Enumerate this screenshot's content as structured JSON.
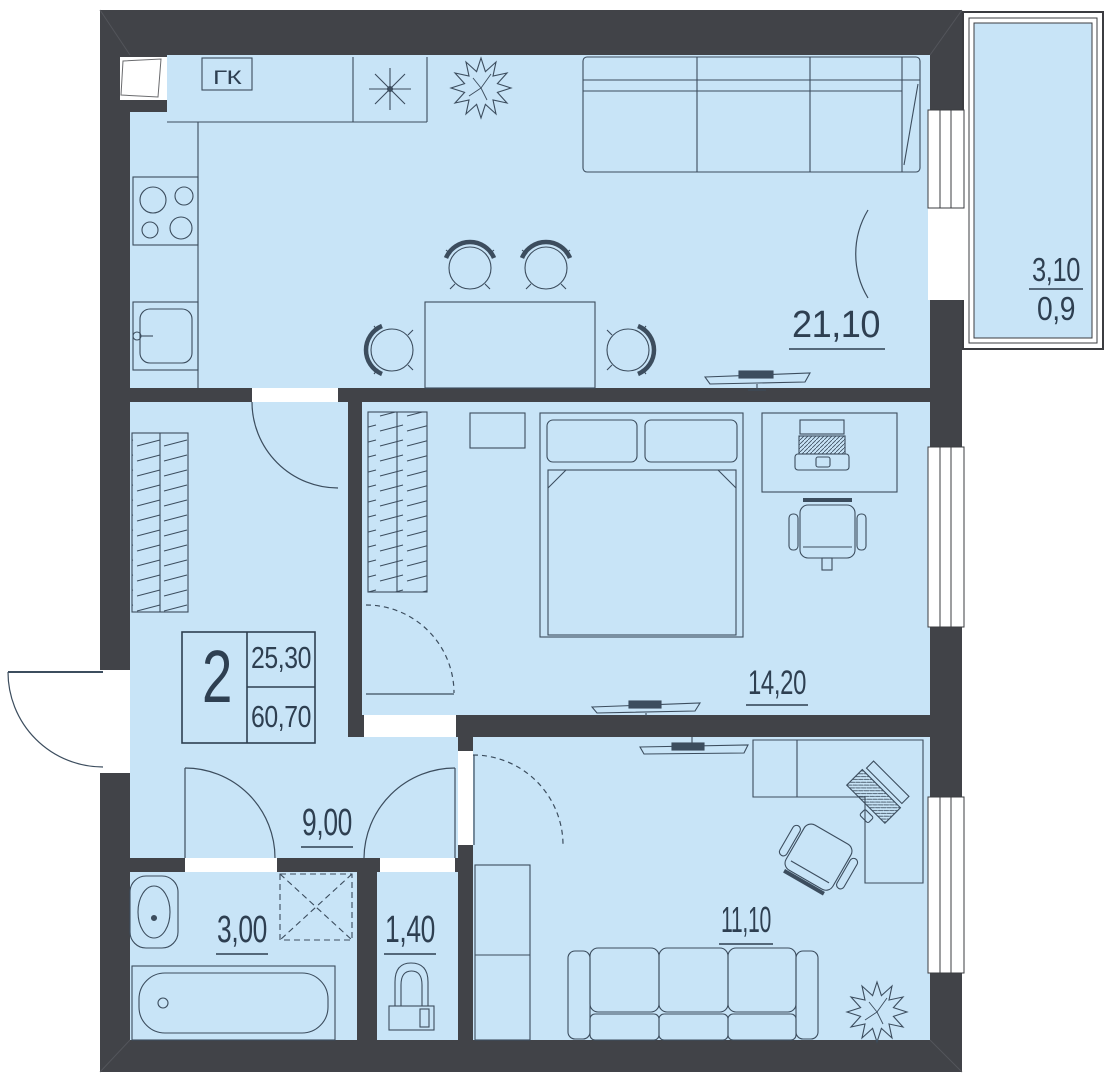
{
  "plan": {
    "stamp": {
      "rooms_count": "2",
      "living_area": "25,30",
      "total_area": "60,70"
    },
    "rooms": {
      "living_kitchen": {
        "area": "21,10"
      },
      "bedroom": {
        "area": "14,20"
      },
      "room2": {
        "area": "11,10"
      },
      "hallway": {
        "area": "9,00"
      },
      "bathroom": {
        "area": "3,00"
      },
      "wc": {
        "area": "1,40"
      },
      "balcony": {
        "area_full": "3,10",
        "area_reduced": "0,9"
      }
    },
    "labels": {
      "closet": "ГК"
    },
    "colors": {
      "floor": "#c8e4f7",
      "wall": "#414348",
      "line": "#3c4d5e",
      "text": "#2e3f51"
    }
  }
}
